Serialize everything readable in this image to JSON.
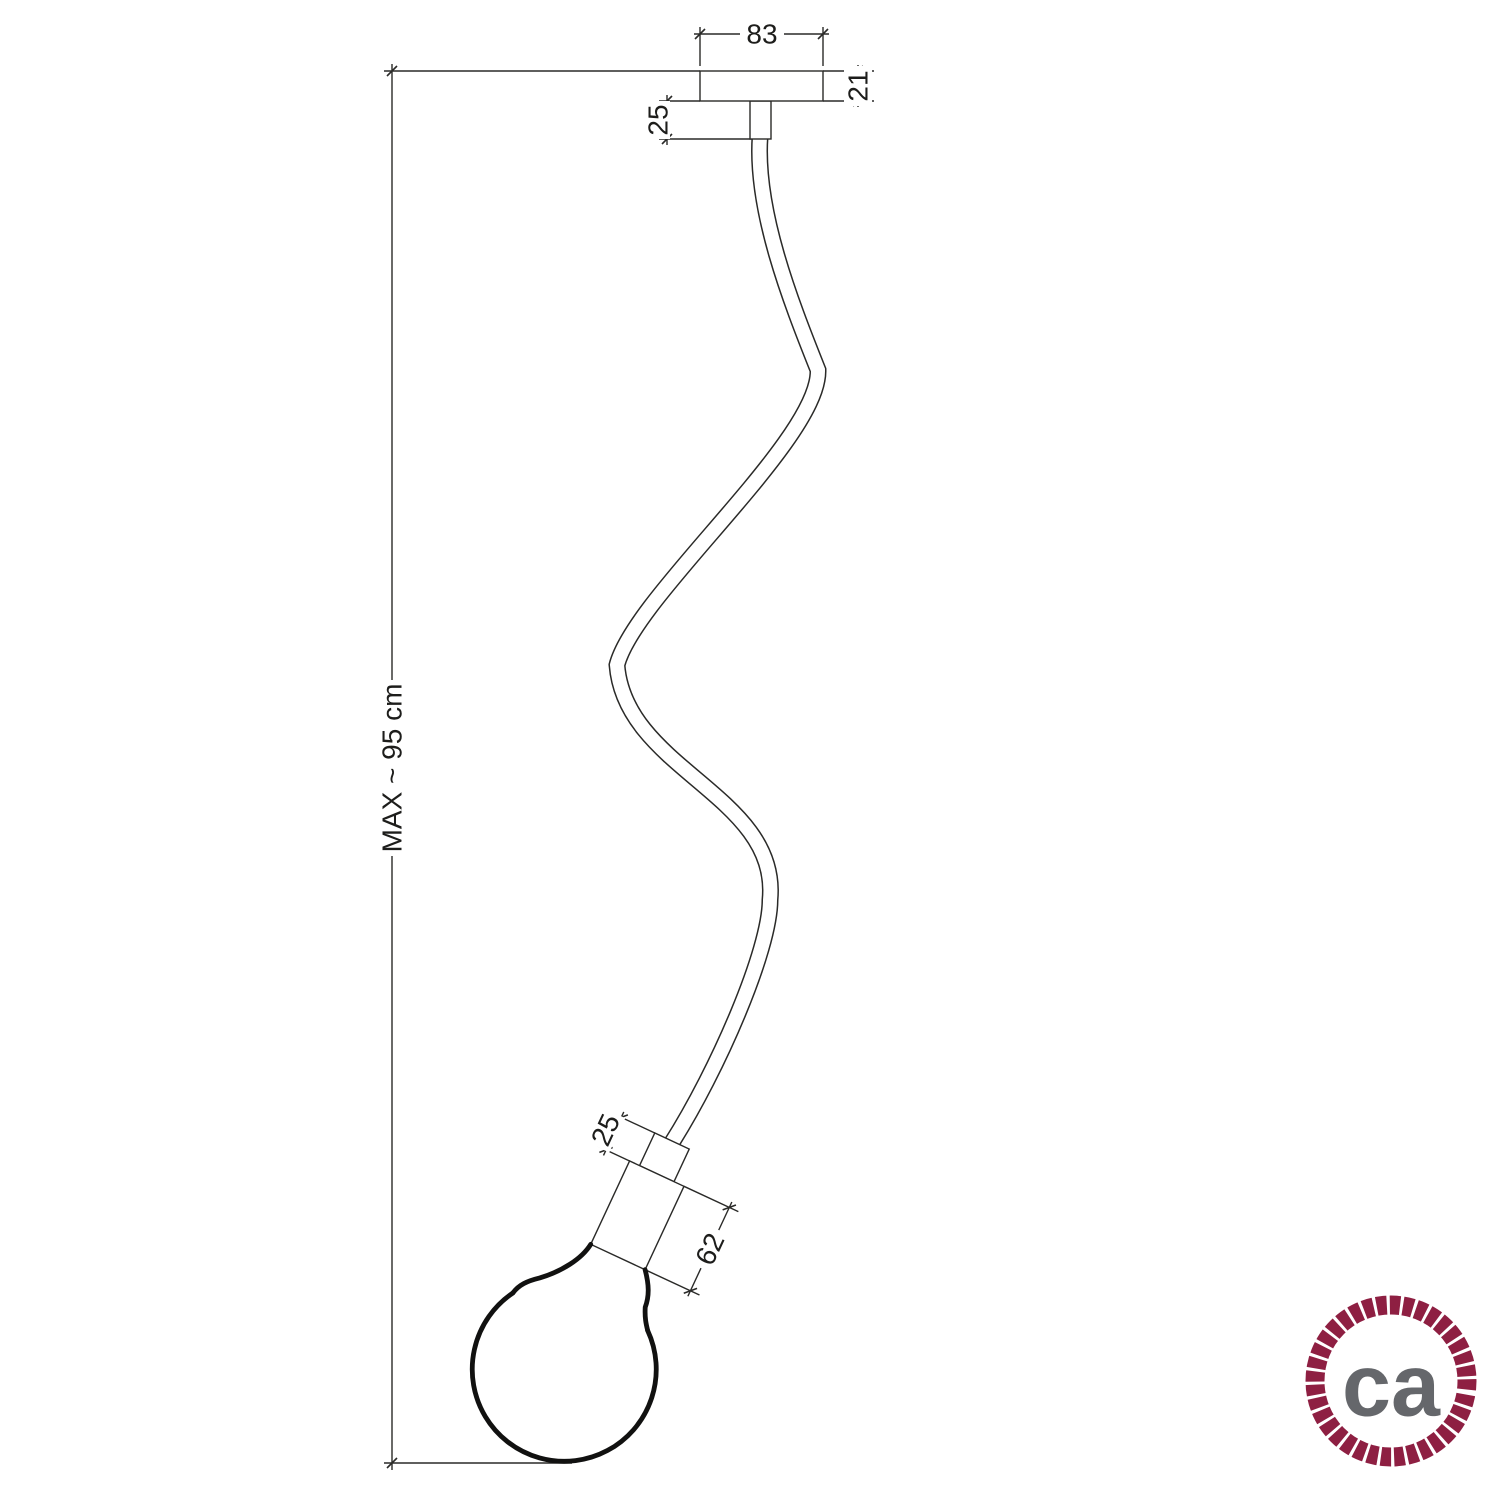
{
  "title": "Flex pendant lamp dimensional drawing",
  "dimensions": {
    "canopy_width": "83",
    "canopy_height": "21",
    "ceiling_stem": "25",
    "max_length": "MAX ~ 95 cm",
    "socket_stem": "25",
    "socket_length": "62"
  },
  "colors": {
    "line": "#2a2a28",
    "rope_red": "#8e1f42",
    "logo_gray": "#65676b",
    "background": "#ffffff"
  },
  "logo": {
    "text": "ca"
  }
}
